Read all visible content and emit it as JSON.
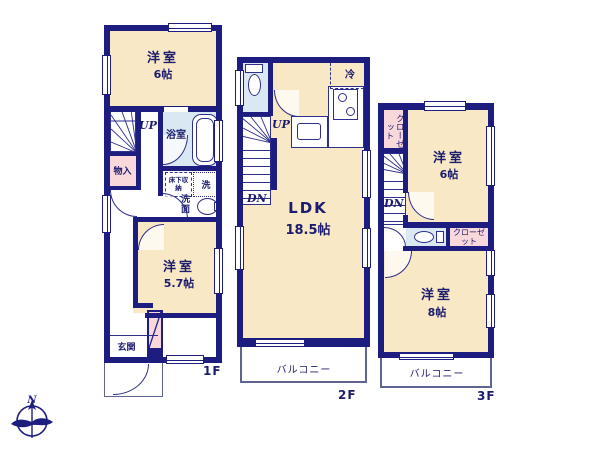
{
  "colors": {
    "wall": "#1d1d80",
    "line": "#2e2e8c",
    "text": "#1c1c6e",
    "room_fill": "#f8e8c6",
    "closet_fill": "#f9d8dc",
    "wet_fill": "#d9e8f3",
    "balcony_line": "#5f6590"
  },
  "compass": {
    "north": "N"
  },
  "floor1": {
    "floor_label": "1F",
    "room6": {
      "name": "洋室",
      "size": "6帖"
    },
    "bathroom": "浴室",
    "storage": "物入",
    "underfloor_storage": "床下収納",
    "laundry": "洗",
    "washroom": "洗面",
    "room57": {
      "name": "洋室",
      "size": "5.7帖"
    },
    "entrance": "玄関",
    "up": "UP"
  },
  "floor2": {
    "floor_label": "2F",
    "ldk": {
      "name": "LDK",
      "size": "18.5帖"
    },
    "fridge": "冷",
    "up": "UP",
    "dn": "DN",
    "balcony": "バルコニー"
  },
  "floor3": {
    "floor_label": "3F",
    "closet_upper": "クローゼット",
    "room6": {
      "name": "洋室",
      "size": "6帖"
    },
    "dn": "DN",
    "closet_lower": "クローゼット",
    "room8": {
      "name": "洋室",
      "size": "8帖"
    },
    "balcony": "バルコニー"
  }
}
